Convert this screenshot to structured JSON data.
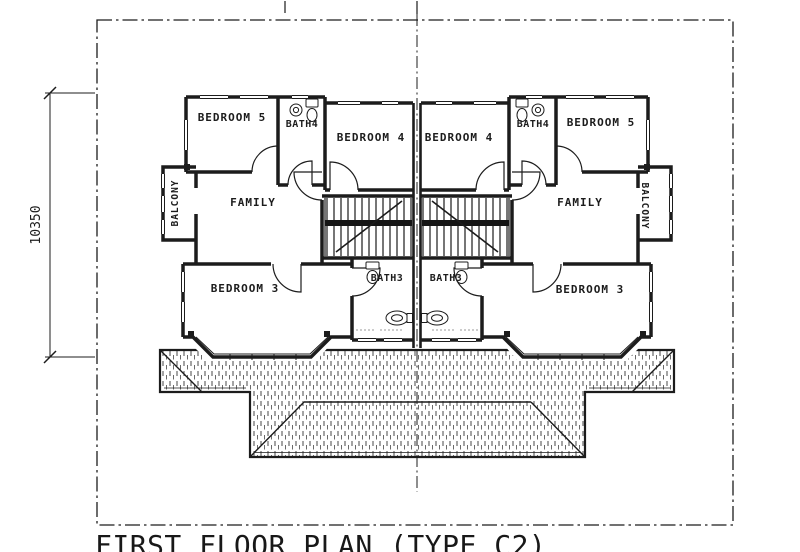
{
  "drawing": {
    "title": "FIRST FLOOR PLAN (TYPE C2)",
    "dimension_left": "10350"
  },
  "rooms": {
    "bedroom5_left": "BEDROOM 5",
    "bath4_left": "BATH4",
    "bedroom4_left": "BEDROOM 4",
    "bedroom4_right": "BEDROOM 4",
    "bath4_right": "BATH4",
    "bedroom5_right": "BEDROOM 5",
    "balcony_left": "BALCONY",
    "family_left": "FAMILY",
    "family_right": "FAMILY",
    "balcony_right": "BALCONY",
    "bedroom3_left": "BEDROOM 3",
    "bath3_left": "BATH3",
    "bath3_right": "BATH3",
    "bedroom3_right": "BEDROOM 3"
  },
  "colors": {
    "ink": "#1c1c1c",
    "paper": "#ffffff"
  }
}
